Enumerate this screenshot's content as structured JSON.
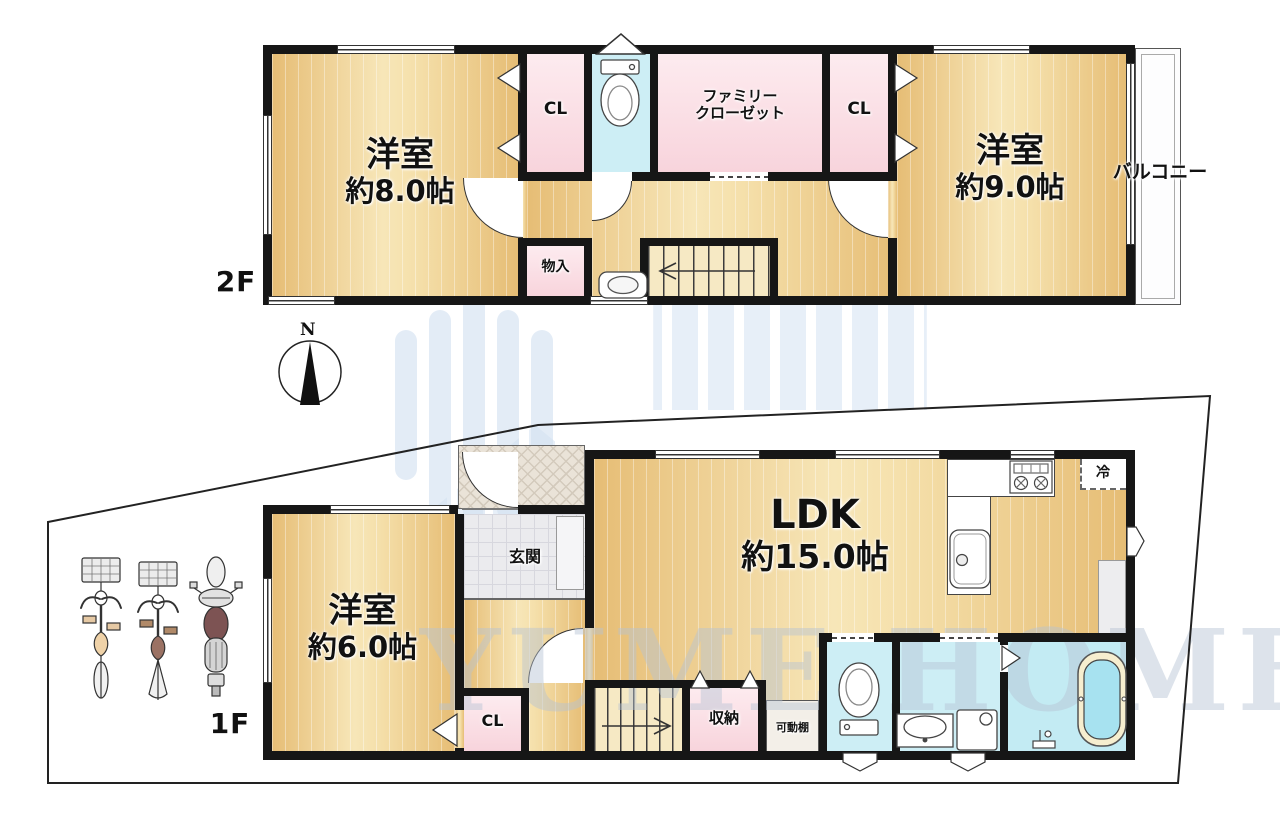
{
  "floor2": {
    "floor_label": "2F",
    "room_8": {
      "name": "洋室",
      "size": "約8.0帖"
    },
    "closet_left": "CL",
    "family_closet_line1": "ファミリー",
    "family_closet_line2": "クローゼット",
    "closet_right": "CL",
    "room_9": {
      "name": "洋室",
      "size": "約9.0帖"
    },
    "storage": "物入",
    "balcony": "バルコニー"
  },
  "floor1": {
    "floor_label": "1F",
    "room_6": {
      "name": "洋室",
      "size": "約6.0帖"
    },
    "entrance": "玄関",
    "ldk": {
      "name": "LDK",
      "size": "約15.0帖"
    },
    "refrigerator": "冷",
    "closet": "CL",
    "storage": "収納",
    "movable_shelf": "可動棚"
  },
  "compass": {
    "north": "N"
  },
  "watermark": {
    "text": "YUME HOME"
  },
  "colors": {
    "wall": "#161616",
    "wood_floor": "#efcf8e",
    "closet_pink": "#f8d4dc",
    "wet_blue": "#cdeef5",
    "tile_gray": "#ebebee",
    "watermark_blue": "#d7e4f3"
  }
}
